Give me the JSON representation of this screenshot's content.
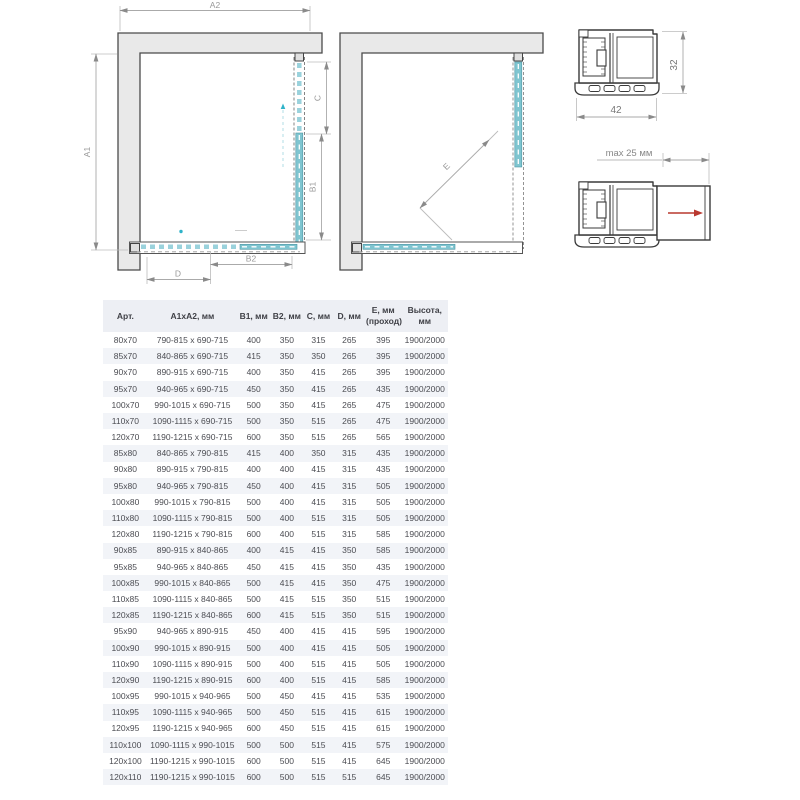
{
  "labels": {
    "a2": "A2",
    "a1": "A1",
    "c": "C",
    "b1": "B1",
    "b2": "B2",
    "d": "D",
    "e": "E",
    "profile_width": "42",
    "profile_height": "32",
    "max_adjust": "max 25 мм"
  },
  "colors": {
    "glass": "#7fc5d0",
    "glass_dash": "#9ad2dc",
    "wall": "#e9e9e9",
    "dim_line": "#aaaaaa",
    "red_arrow": "#b9382f",
    "table_header_bg": "#edeff4",
    "table_alt_row": "#f2f4f8"
  },
  "table": {
    "columns": [
      "Арт.",
      "A1xA2, мм",
      "B1, мм",
      "B2, мм",
      "C, мм",
      "D, мм",
      "E, мм\n(проход)",
      "Высота, мм"
    ],
    "rows": [
      [
        "80x70",
        "790-815 x 690-715",
        "400",
        "350",
        "315",
        "265",
        "395",
        "1900/2000"
      ],
      [
        "85x70",
        "840-865 x 690-715",
        "415",
        "350",
        "350",
        "265",
        "395",
        "1900/2000"
      ],
      [
        "90x70",
        "890-915 x 690-715",
        "400",
        "350",
        "415",
        "265",
        "395",
        "1900/2000"
      ],
      [
        "95x70",
        "940-965 x 690-715",
        "450",
        "350",
        "415",
        "265",
        "435",
        "1900/2000"
      ],
      [
        "100x70",
        "990-1015 x 690-715",
        "500",
        "350",
        "415",
        "265",
        "475",
        "1900/2000"
      ],
      [
        "110x70",
        "1090-1115 x 690-715",
        "500",
        "350",
        "515",
        "265",
        "475",
        "1900/2000"
      ],
      [
        "120x70",
        "1190-1215 x 690-715",
        "600",
        "350",
        "515",
        "265",
        "565",
        "1900/2000"
      ],
      [
        "85x80",
        "840-865 x 790-815",
        "415",
        "400",
        "350",
        "315",
        "435",
        "1900/2000"
      ],
      [
        "90x80",
        "890-915 x 790-815",
        "400",
        "400",
        "415",
        "315",
        "435",
        "1900/2000"
      ],
      [
        "95x80",
        "940-965 x 790-815",
        "450",
        "400",
        "415",
        "315",
        "505",
        "1900/2000"
      ],
      [
        "100x80",
        "990-1015 x 790-815",
        "500",
        "400",
        "415",
        "315",
        "505",
        "1900/2000"
      ],
      [
        "110x80",
        "1090-1115 x 790-815",
        "500",
        "400",
        "515",
        "315",
        "505",
        "1900/2000"
      ],
      [
        "120x80",
        "1190-1215 x 790-815",
        "600",
        "400",
        "515",
        "315",
        "585",
        "1900/2000"
      ],
      [
        "90x85",
        "890-915 x 840-865",
        "400",
        "415",
        "415",
        "350",
        "585",
        "1900/2000"
      ],
      [
        "95x85",
        "940-965 x 840-865",
        "450",
        "415",
        "415",
        "350",
        "435",
        "1900/2000"
      ],
      [
        "100x85",
        "990-1015 x 840-865",
        "500",
        "415",
        "415",
        "350",
        "475",
        "1900/2000"
      ],
      [
        "110x85",
        "1090-1115 x 840-865",
        "500",
        "415",
        "515",
        "350",
        "515",
        "1900/2000"
      ],
      [
        "120x85",
        "1190-1215 x 840-865",
        "600",
        "415",
        "515",
        "350",
        "515",
        "1900/2000"
      ],
      [
        "95x90",
        "940-965 x 890-915",
        "450",
        "400",
        "415",
        "415",
        "595",
        "1900/2000"
      ],
      [
        "100x90",
        "990-1015 x 890-915",
        "500",
        "400",
        "415",
        "415",
        "505",
        "1900/2000"
      ],
      [
        "110x90",
        "1090-1115 x 890-915",
        "500",
        "400",
        "515",
        "415",
        "505",
        "1900/2000"
      ],
      [
        "120x90",
        "1190-1215 x 890-915",
        "600",
        "400",
        "515",
        "415",
        "585",
        "1900/2000"
      ],
      [
        "100x95",
        "990-1015 x 940-965",
        "500",
        "450",
        "415",
        "415",
        "535",
        "1900/2000"
      ],
      [
        "110x95",
        "1090-1115 x 940-965",
        "500",
        "450",
        "515",
        "415",
        "615",
        "1900/2000"
      ],
      [
        "120x95",
        "1190-1215 x 940-965",
        "600",
        "450",
        "515",
        "415",
        "615",
        "1900/2000"
      ],
      [
        "110x100",
        "1090-1115 x 990-1015",
        "500",
        "500",
        "515",
        "415",
        "575",
        "1900/2000"
      ],
      [
        "120x100",
        "1190-1215 x 990-1015",
        "600",
        "500",
        "515",
        "415",
        "645",
        "1900/2000"
      ],
      [
        "120x110",
        "1190-1215 x 990-1015",
        "600",
        "500",
        "515",
        "515",
        "645",
        "1900/2000"
      ]
    ]
  }
}
